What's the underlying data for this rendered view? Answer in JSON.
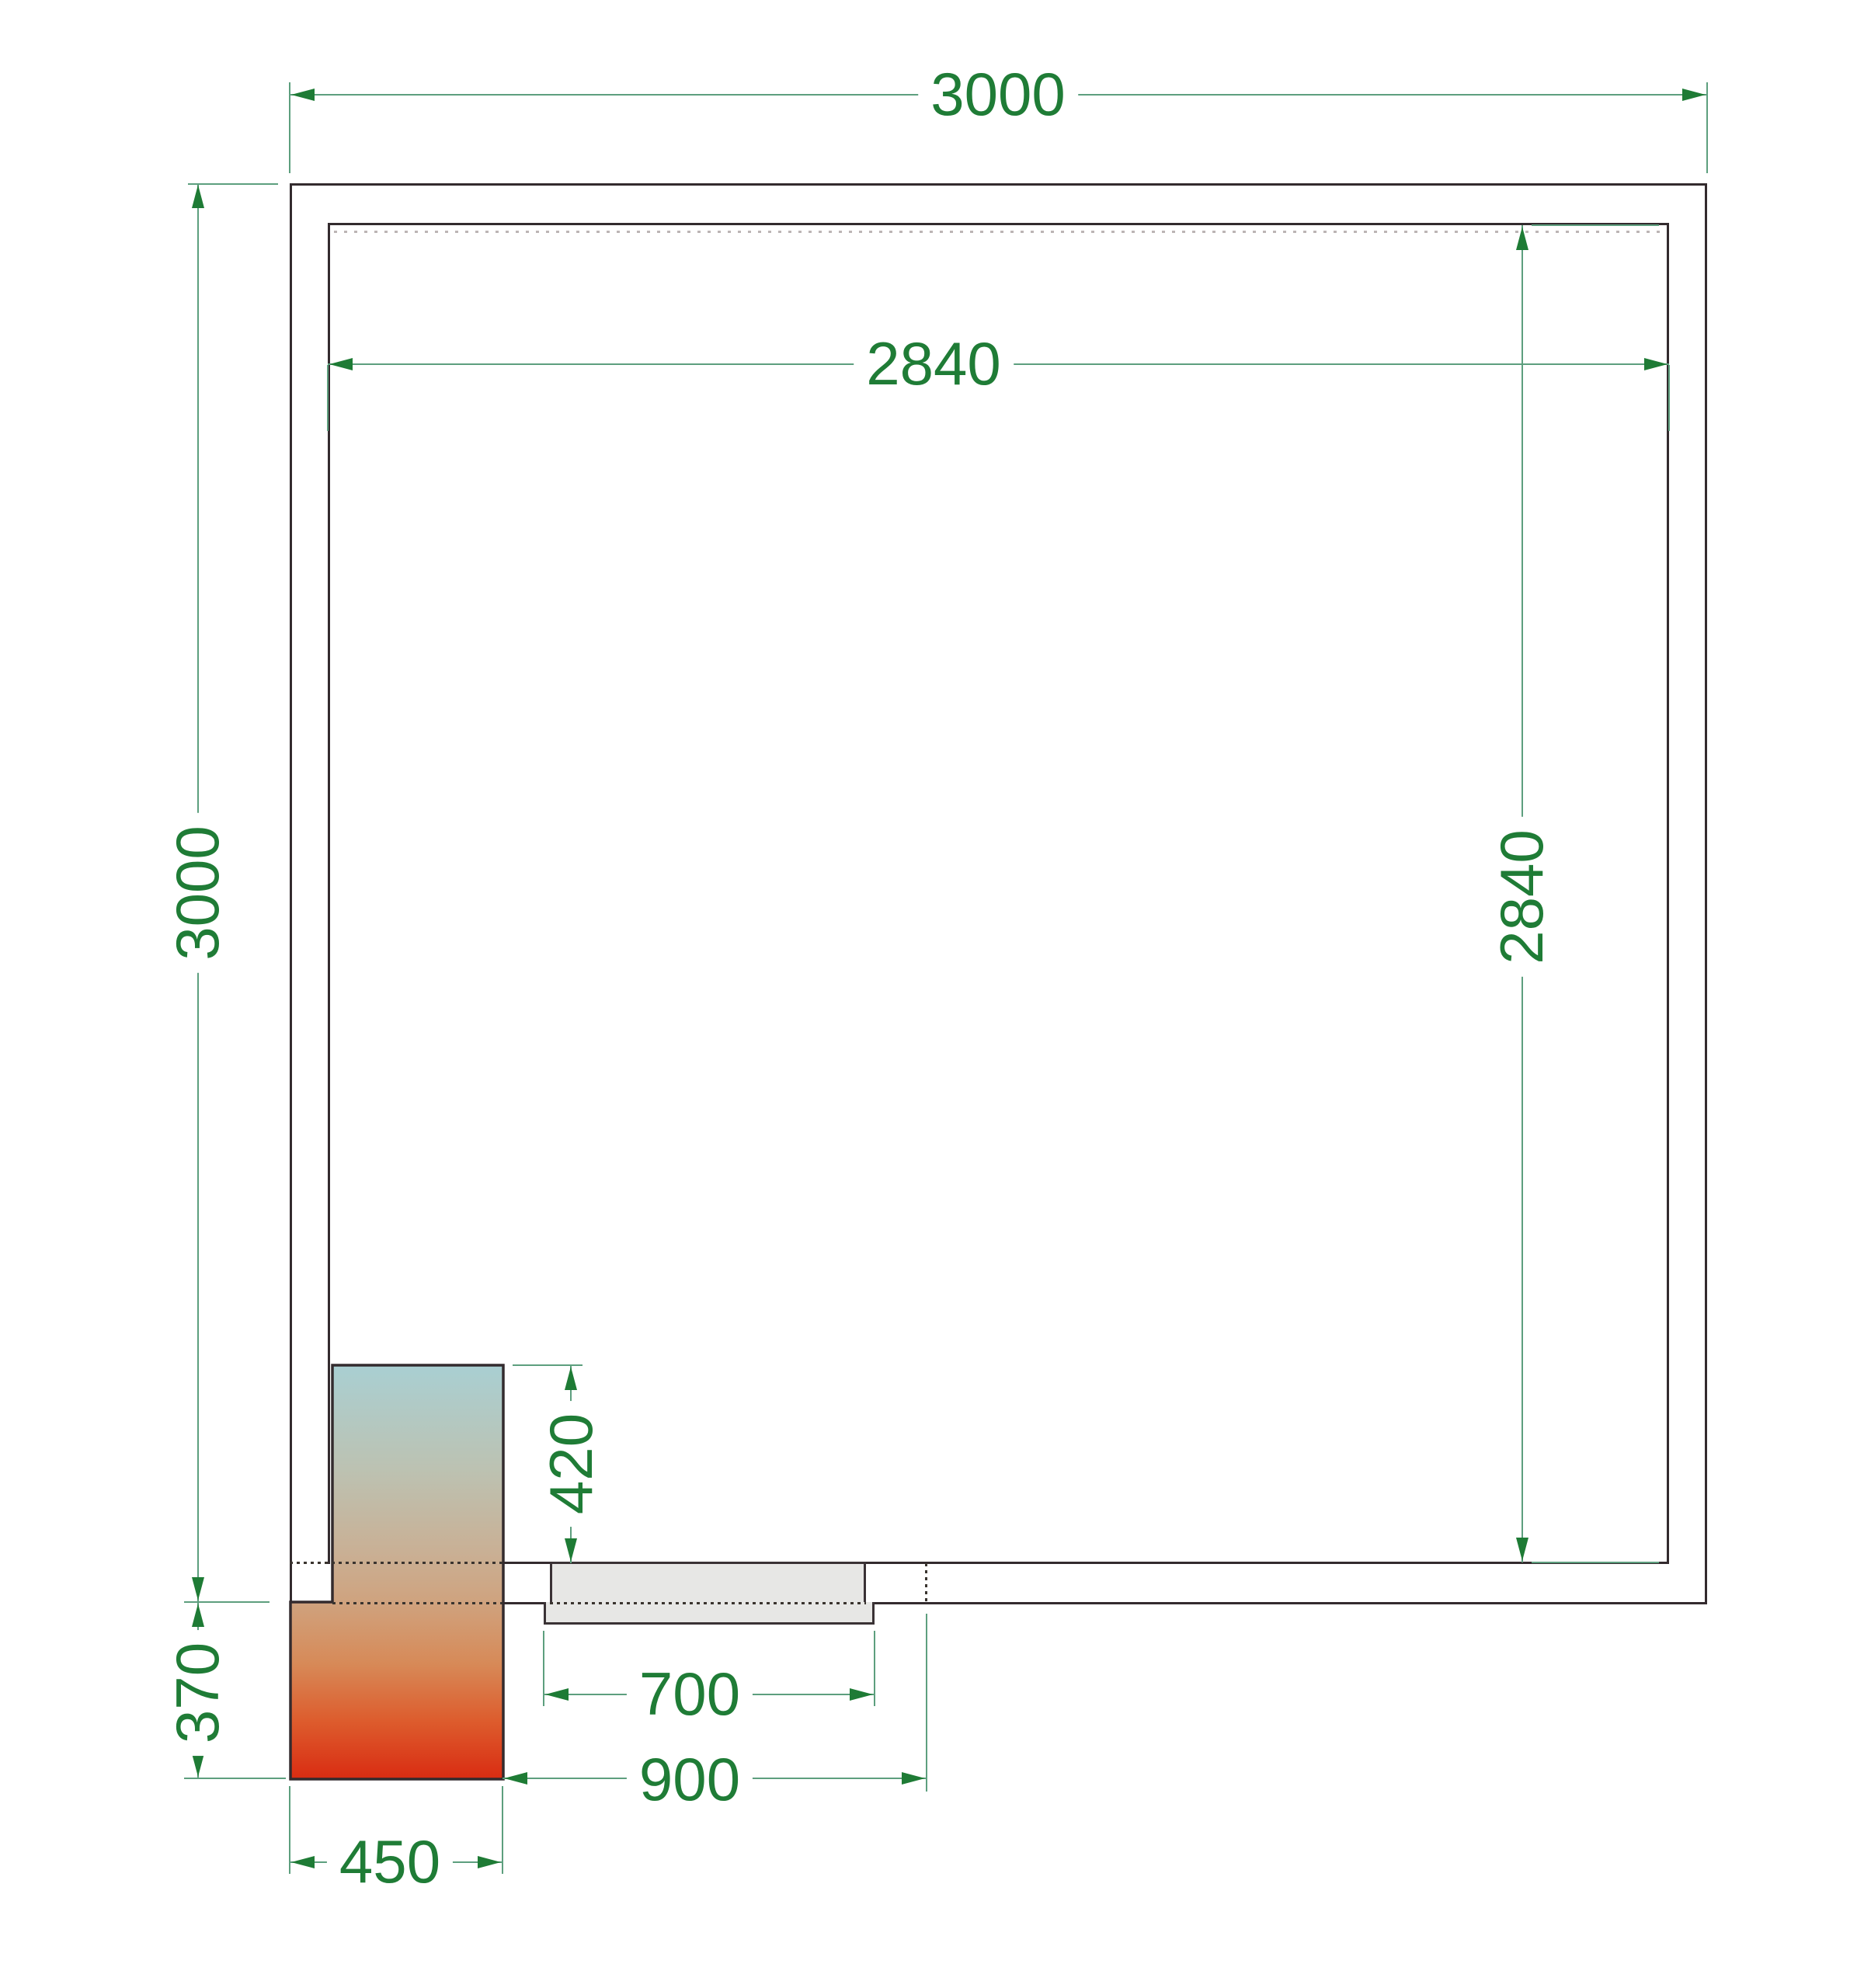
{
  "drawing": {
    "type": "cold-room floor plan, top view",
    "room": {
      "outer_size_mm": "3000 x 3000",
      "inner_size_mm": "2840 x 2840"
    }
  },
  "dimensions": {
    "outer_width": "3000",
    "inner_width": "2840",
    "outer_height": "3000",
    "inner_height": "2840",
    "unit_inner_depth": "420",
    "unit_outer_depth": "370",
    "door_leaf_width": "700",
    "door_opening_width": "900",
    "unit_width": "450"
  },
  "colors": {
    "dimension_text": "#1f7c36",
    "dimension_line": "#5d9f7e",
    "arrow": "#1e7b35",
    "wall_line": "#332b2e",
    "hidden_line": "#3a342f",
    "ceiling_hidden_line": "#bcb5b5",
    "door_fill": "#e7e7e5",
    "unit_gradient_top": "#a9cfd2",
    "unit_gradient_middle": "#cfa37f",
    "unit_gradient_bottom": "#d92c12"
  }
}
